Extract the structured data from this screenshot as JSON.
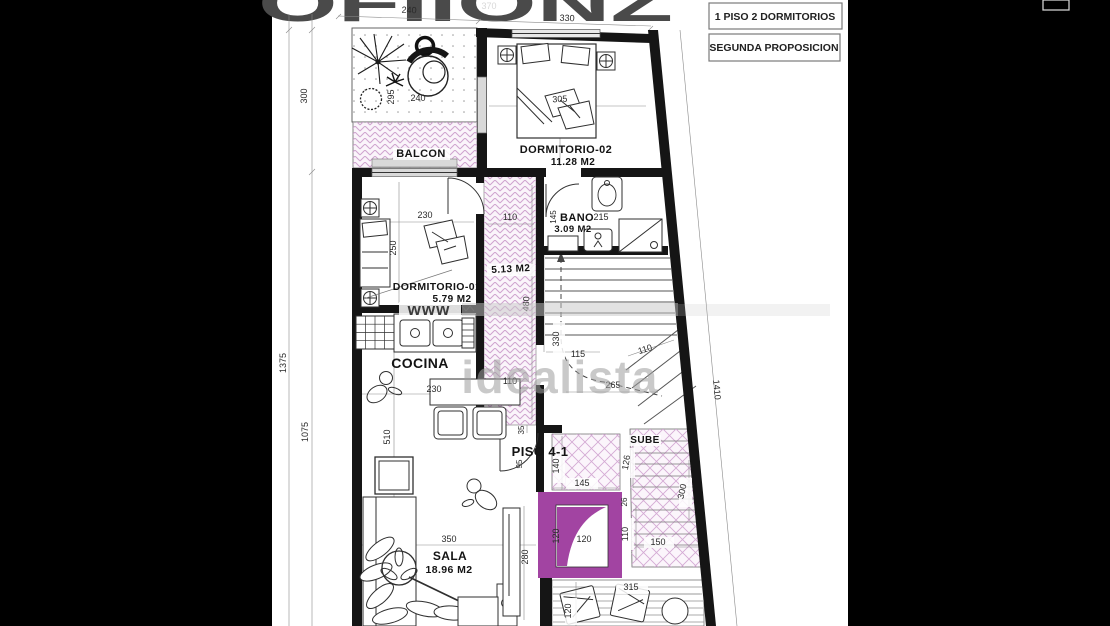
{
  "page": {
    "background": "#000000",
    "paper": "#ffffff"
  },
  "header": {
    "logo_fragment": "OFIIONZ",
    "logo_dim": "370",
    "title_box_1": "1 PISO 2 DORMITORIOS",
    "title_box_2": "SEGUNDA PROPOSICION"
  },
  "watermarks": {
    "www": "www",
    "brand": "idealista"
  },
  "colors": {
    "background": "#000000",
    "paper": "#ffffff",
    "wall": "#151515",
    "hatch_pink": "#cfa3cf",
    "magenta": "#a244a2",
    "watermark_gray": "#9e9e9e"
  },
  "rooms": {
    "balcon": {
      "name": "BALCON"
    },
    "dormitorio2": {
      "name": "DORMITORIO-02",
      "area": "11.28 M2"
    },
    "bano": {
      "name": "BANO",
      "area": "3.09 M2"
    },
    "dormitorio1": {
      "name": "DORMITORIO-01",
      "area": "5.79 M2"
    },
    "pasillo": {
      "area": "5.13 M2"
    },
    "cocina": {
      "name": "COCINA"
    },
    "sala": {
      "name": "SALA",
      "area": "18.96 M2"
    },
    "piso_label": "PISO 4-1",
    "sube": "SUBE"
  },
  "dims": {
    "top_240": "240",
    "top_330": "330",
    "left_300": "300",
    "left_1375": "1375",
    "left_1075": "1075",
    "terraza_295": "295",
    "terraza_240": "240",
    "dorm2_305": "305",
    "bano_145": "145",
    "bano_215": "215",
    "dorm1_230": "230",
    "dorm1_250": "250",
    "pasillo_110_top": "110",
    "pasillo_480": "480",
    "pasillo_110_bottom": "110",
    "cocina_230": "230",
    "cocina_510": "510",
    "stairs_330": "330",
    "stairs_115": "115",
    "stairs_110": "110",
    "stairs_265": "265",
    "right_1410": "1410",
    "entry_35": "35",
    "entry_95": "95",
    "landing_140": "140",
    "landing_145": "145",
    "landing_126": "126",
    "sube_300": "300",
    "sube_26": "26",
    "sube_110": "110",
    "sube_150": "150",
    "elev_120_v": "120",
    "elev_120_h": "120",
    "sala_350": "350",
    "sala_280": "280",
    "deck_315": "315",
    "deck_120": "120"
  }
}
